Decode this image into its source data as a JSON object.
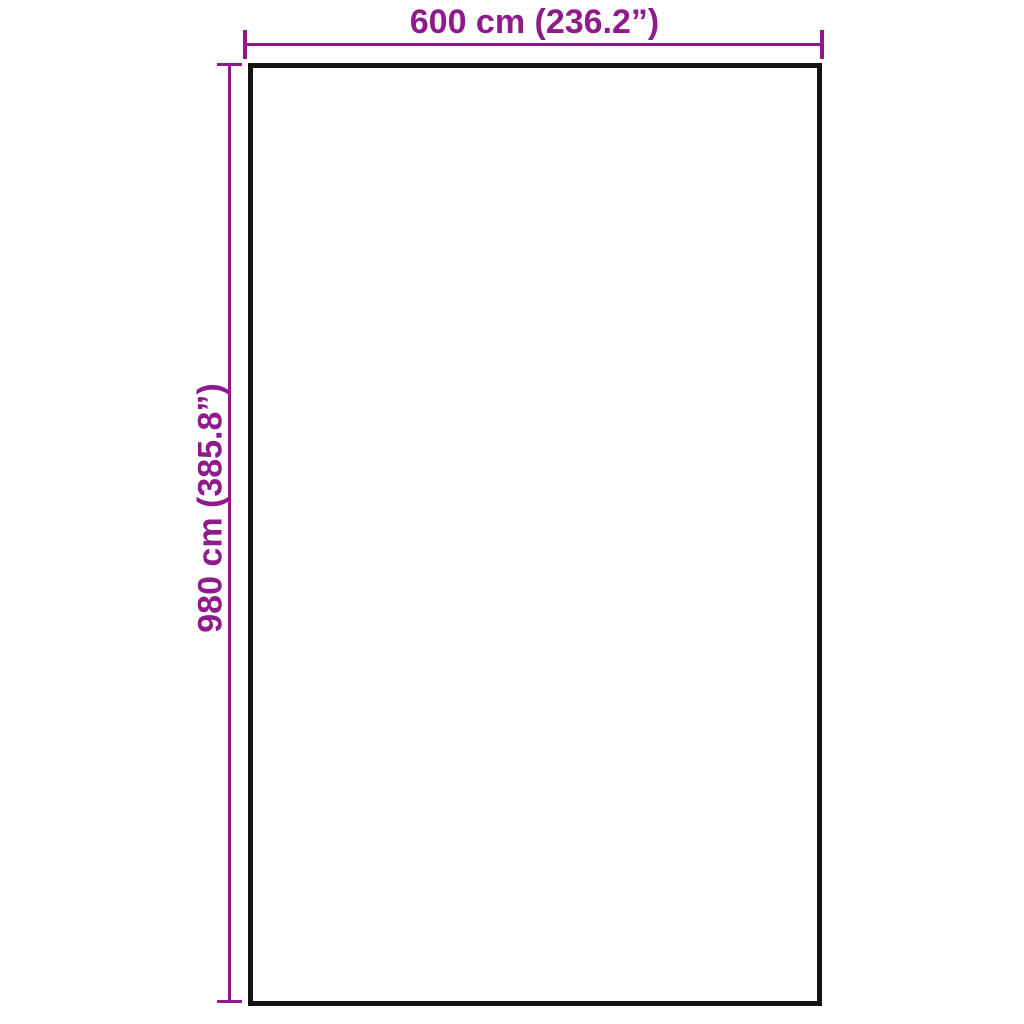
{
  "diagram": {
    "type": "product-dimension-diagram",
    "background_color": "#FFFFFF",
    "outline_color": "#141414",
    "dimension_color": "#8E1A8C",
    "width": {
      "label": "600 cm (236.2”)",
      "value_cm": 600,
      "value_inches": 236.2
    },
    "height": {
      "label": "980 cm (385.8”)",
      "value_cm": 980,
      "value_inches": 385.8
    }
  }
}
